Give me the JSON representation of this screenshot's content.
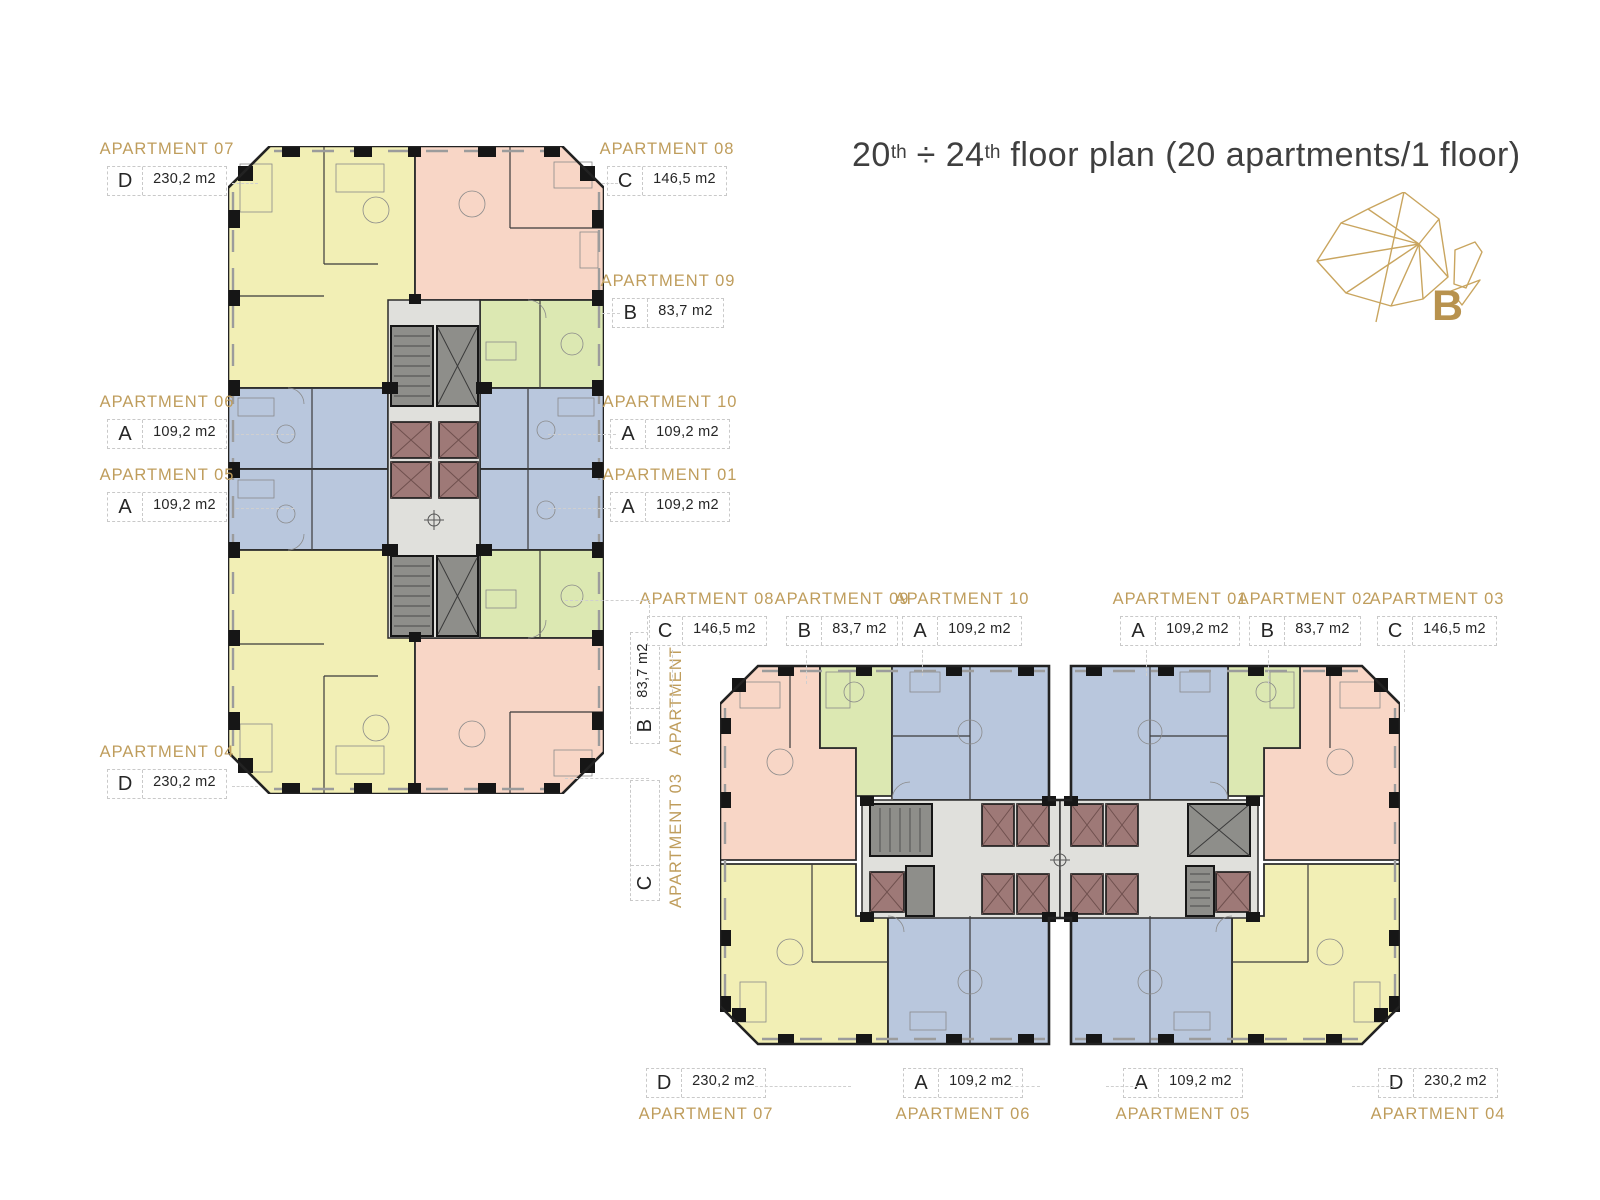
{
  "title": {
    "n1": "20",
    "s1": "th",
    "sep": " ÷ ",
    "n2": "24",
    "s2": "th",
    "rest": " floor plan (20 apartments/1 floor)"
  },
  "logo": {
    "letter": "B"
  },
  "labels": [
    {
      "tower": "left",
      "name": "APARTMENT 07",
      "letter": "D",
      "area": "230,2 m2"
    },
    {
      "tower": "left",
      "name": "APARTMENT 08",
      "letter": "C",
      "area": "146,5 m2"
    },
    {
      "tower": "left",
      "name": "APARTMENT 09",
      "letter": "B",
      "area": "83,7 m2"
    },
    {
      "tower": "left",
      "name": "APARTMENT 06",
      "letter": "A",
      "area": "109,2 m2"
    },
    {
      "tower": "left",
      "name": "APARTMENT 10",
      "letter": "A",
      "area": "109,2 m2"
    },
    {
      "tower": "left",
      "name": "APARTMENT 05",
      "letter": "A",
      "area": "109,2 m2"
    },
    {
      "tower": "left",
      "name": "APARTMENT 01",
      "letter": "A",
      "area": "109,2 m2"
    },
    {
      "tower": "left",
      "name": "APARTMENT 04",
      "letter": "D",
      "area": "230,2 m2"
    },
    {
      "tower": "left",
      "name": "APARTMENT 02",
      "letter": "B",
      "area": "83,7 m2"
    },
    {
      "tower": "left",
      "name": "APARTMENT 03",
      "letter": "C",
      "area": ""
    },
    {
      "tower": "right",
      "name": "APARTMENT 08",
      "letter": "C",
      "area": "146,5 m2"
    },
    {
      "tower": "right",
      "name": "APARTMENT 09",
      "letter": "B",
      "area": "83,7 m2"
    },
    {
      "tower": "right",
      "name": "APARTMENT 10",
      "letter": "A",
      "area": "109,2 m2"
    },
    {
      "tower": "right",
      "name": "APARTMENT 01",
      "letter": "A",
      "area": "109,2 m2"
    },
    {
      "tower": "right",
      "name": "APARTMENT 02",
      "letter": "B",
      "area": "83,7 m2"
    },
    {
      "tower": "right",
      "name": "APARTMENT 03",
      "letter": "C",
      "area": "146,5 m2"
    },
    {
      "tower": "right",
      "name": "APARTMENT 07",
      "letter": "D",
      "area": "230,2 m2"
    },
    {
      "tower": "right",
      "name": "APARTMENT 06",
      "letter": "A",
      "area": "109,2 m2"
    },
    {
      "tower": "right",
      "name": "APARTMENT 05",
      "letter": "A",
      "area": "109,2 m2"
    },
    {
      "tower": "right",
      "name": "APARTMENT 04",
      "letter": "D",
      "area": "230,2 m2"
    }
  ],
  "palette": {
    "label_gold": "#bf9d5c",
    "title_gray": "#3f3f3f",
    "apartment_yellow": "#f2efb5",
    "apartment_pink": "#f8d6c6",
    "apartment_green": "#dce8b2",
    "apartment_blue": "#b9c7dd",
    "core_corridor": "#e0e0dc",
    "core_stairs": "#8e8e8a",
    "elevator_brown": "#9e7977",
    "wall_black": "#161616"
  }
}
